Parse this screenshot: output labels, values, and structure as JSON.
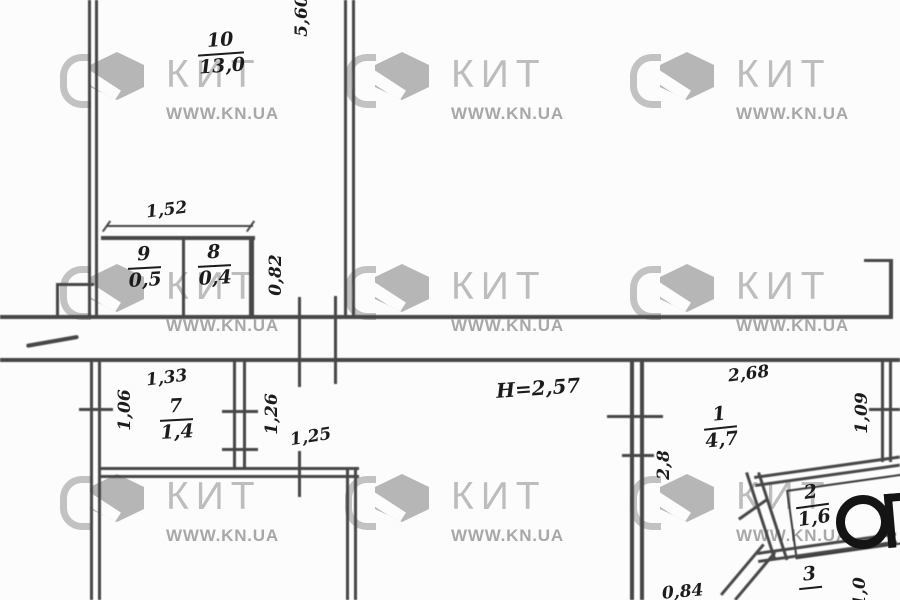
{
  "watermark": {
    "brand": "КИТ",
    "url": "WWW.KN.UA"
  },
  "plan": {
    "rooms": [
      {
        "number": "10",
        "area": "13,0"
      },
      {
        "number": "9",
        "area": "0,5"
      },
      {
        "number": "8",
        "area": "0,4"
      },
      {
        "number": "7",
        "area": "1,4"
      },
      {
        "number": "1",
        "area": "4,7"
      },
      {
        "number": "2",
        "area": "1,6"
      },
      {
        "number": "3",
        "area": ""
      }
    ],
    "ceiling_height": "H=2,57",
    "dimensions": {
      "d560": "5,60",
      "d152": "1,52",
      "d082": "0,82",
      "d106": "1,06",
      "d133": "1,33",
      "d126": "1,26",
      "d125": "1,25",
      "d268": "2,68",
      "d109": "1,09",
      "d28": "2,8",
      "d084": "0,84",
      "d10": "1,0"
    },
    "stamp": "СП"
  }
}
